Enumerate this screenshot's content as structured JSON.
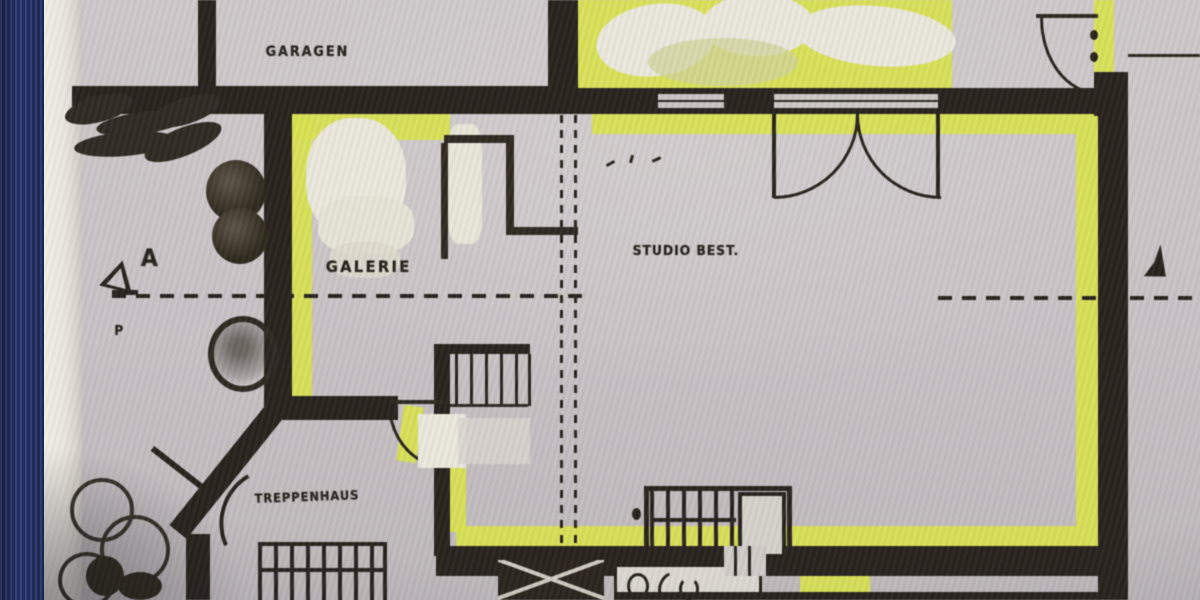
{
  "floor_plan": {
    "labels": {
      "garage": "GARAGEN",
      "gallery": "GALERIE",
      "studio": "STUDIO BEST.",
      "stairwell": "TREPPENHAUS"
    },
    "section_marker": {
      "letter": "A",
      "sub_symbol": "P"
    },
    "colors": {
      "highlighter": "#d8e24c",
      "ink": "#241f19",
      "paper": "#c7c1c4",
      "paper_edge": "#ece9e1",
      "binder_spine": "#22306a"
    }
  }
}
